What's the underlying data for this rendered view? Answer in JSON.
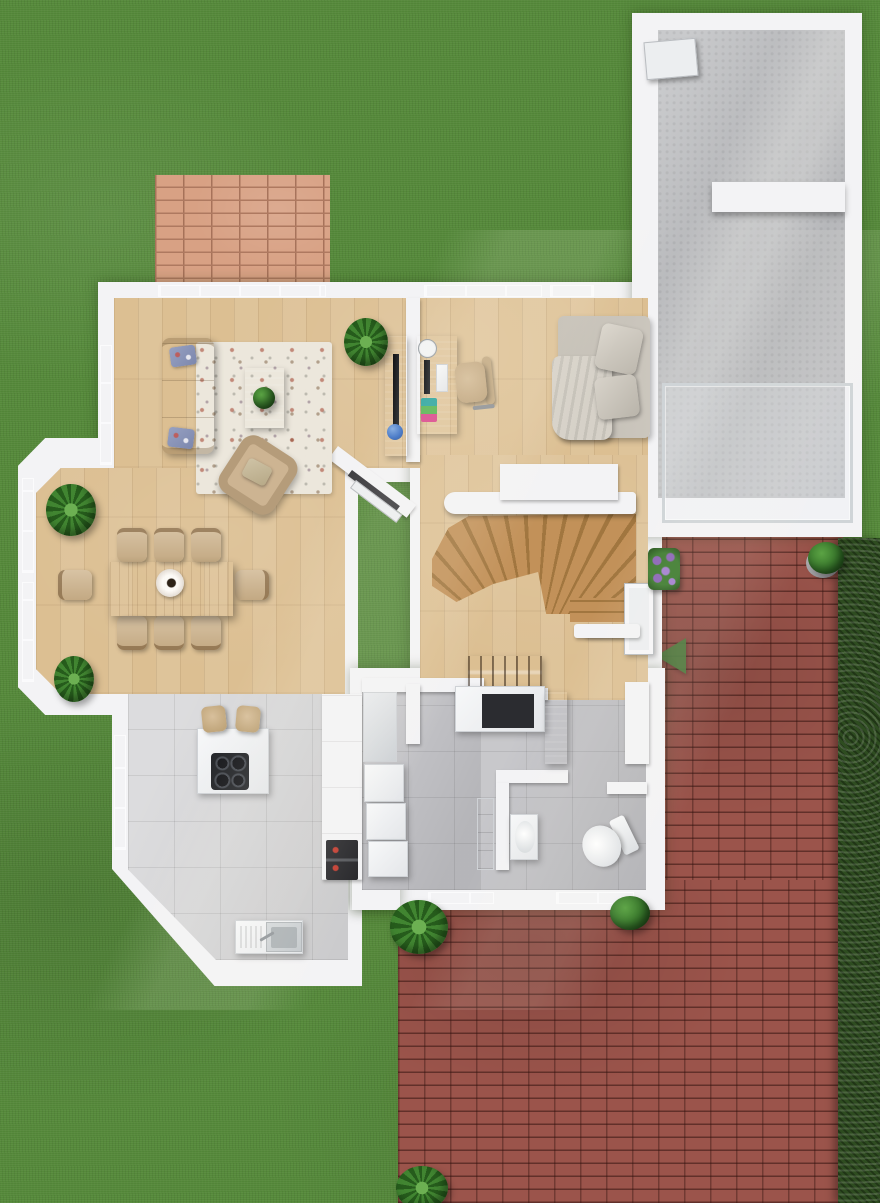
{
  "meta": {
    "title": "3D ground-floor plan render — top-down view",
    "view": "top-down architectural render",
    "canvas": {
      "width": 880,
      "height": 1203
    }
  },
  "palette": {
    "grass": "#55893a",
    "grass_shadow": "#47762f",
    "hedge": "#2e4c20",
    "brick_light": "#d8a184",
    "brick_light_mortar": "#ae7960",
    "brick_dark": "#9b544b",
    "brick_dark_mortar": "#5f2b25",
    "wall": "#f3f3f5",
    "wall_edge": "#d9d9de",
    "wood": "#dcbf92",
    "wood_furniture": "#bc9164",
    "stair_wood": "#c29159",
    "stair_wood_dark": "#a1763f",
    "tile_light": "#d6d6d8",
    "tile_dark": "#bfbfc3",
    "concrete": "#bcbdc0",
    "glass": "#d3d9dd",
    "sofa_beige": "#cdb492",
    "daybed_gray": "#cbc6bd",
    "rug_cream": "#ece7dc",
    "appliance_white": "#eef0f2",
    "cooktop_black": "#222428",
    "oven_black": "#26262a",
    "arrow_green": "#4a7a3c",
    "plant": "#36742a",
    "flowers": "#8a63b5",
    "steel": "#c3c8cc"
  },
  "rooms": [
    {
      "id": "living-room",
      "label": "Living room",
      "floor": "oak plank"
    },
    {
      "id": "home-office",
      "label": "Home office",
      "floor": "oak plank"
    },
    {
      "id": "lounge-nook",
      "label": "Lounge nook with daybed",
      "floor": "oak plank"
    },
    {
      "id": "dining-area",
      "label": "Dining area",
      "floor": "oak plank"
    },
    {
      "id": "hallway",
      "label": "Hallway & winder staircase",
      "floor": "oak plank"
    },
    {
      "id": "kitchen",
      "label": "Kitchen",
      "floor": "light gray tile"
    },
    {
      "id": "utility-room",
      "label": "Utility room",
      "floor": "gray tile"
    },
    {
      "id": "bathroom",
      "label": "Bathroom",
      "floor": "gray tile"
    },
    {
      "id": "garage-annex",
      "label": "Garage annex — two rooms",
      "floor": "concrete"
    },
    {
      "id": "terrace",
      "label": "Concrete terrace with glass railing",
      "floor": "concrete"
    }
  ],
  "labels": {
    "lawn": "Lawn",
    "hedge": "Hedge",
    "patio": "Light brick patio",
    "driveway": "Red brick driveway and garden path",
    "entrance_arrow": "Entrance direction arrow",
    "sofa": "Three-seat sofa",
    "armchair": "Armchair",
    "coffee_table": "Coffee table with plant",
    "area_rug": "Speckled cream area rug",
    "tv_sideboard": "TV sideboard with globe",
    "desk": "Desk with monitor, keyboard and books",
    "office_chair": "Office chair",
    "daybed": "Daybed with pillows and throw",
    "dining_table": "Dining table for eight",
    "dining_chair": "Dining chair",
    "centerpiece": "Table centerpiece",
    "kitchen_island": "Kitchen island",
    "cooktop": "Induction cooktop",
    "bar_stool": "Bar stool",
    "sink_counter": "Counter with stainless sink",
    "tall_cabinets": "Tall cabinet column",
    "oven": "Built-in oven",
    "washer_stack": "Laundry appliance stack",
    "utility_cabinet": "Utility cabinet",
    "coat_rack": "Coat rack",
    "hall_cabinet": "Hall cabinet",
    "wood_cabinet": "Wooden cabinet",
    "bath_vanity": "Washbasin vanity",
    "toilet": "Toilet",
    "bath_shelf": "Bathroom shelf",
    "staircase": "Winder staircase",
    "banister": "Staircase banister",
    "entrance_door": "Entrance door",
    "entrance_canopy": "Entrance canopy",
    "glass_railing": "Glass railing",
    "garage_door": "Annex side door",
    "radiator": "Radiator by open door",
    "open_door": "Open interior door",
    "plant": "Potted plant",
    "bush": "Garden bush",
    "flower_planter": "Flower planter",
    "window": "Window"
  }
}
